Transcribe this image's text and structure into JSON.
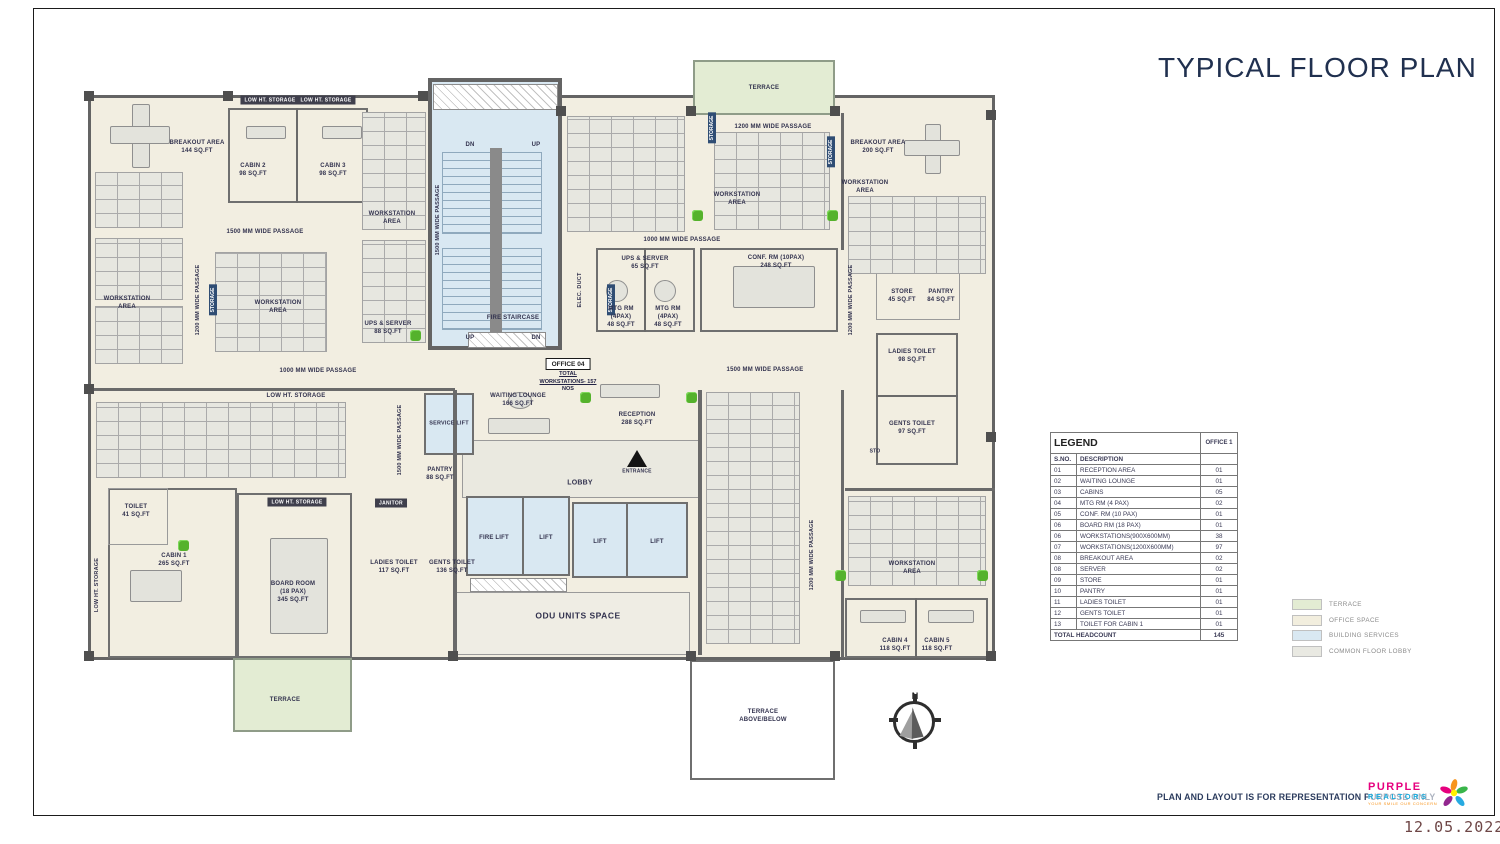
{
  "title": "TYPICAL FLOOR PLAN",
  "legend": {
    "title": "LEGEND",
    "office_header": "OFFICE 1",
    "sno_header": "S.NO.",
    "desc_header": "DESCRIPTION",
    "rows": [
      {
        "sno": "01",
        "desc": "RECEPTION AREA",
        "qty": "01"
      },
      {
        "sno": "02",
        "desc": "WAITING LOUNGE",
        "qty": "01"
      },
      {
        "sno": "03",
        "desc": "CABINS",
        "qty": "05"
      },
      {
        "sno": "04",
        "desc": "MTG RM (4 PAX)",
        "qty": "02"
      },
      {
        "sno": "05",
        "desc": "CONF. RM (10 PAX)",
        "qty": "01"
      },
      {
        "sno": "06",
        "desc": "BOARD RM (18 PAX)",
        "qty": "01"
      },
      {
        "sno": "06",
        "desc": "WORKSTATIONS(900X600MM)",
        "qty": "38"
      },
      {
        "sno": "07",
        "desc": "WORKSTATIONS(1200X600MM)",
        "qty": "97"
      },
      {
        "sno": "08",
        "desc": "BREAKOUT AREA",
        "qty": "02"
      },
      {
        "sno": "08",
        "desc": "SERVER",
        "qty": "02"
      },
      {
        "sno": "09",
        "desc": "STORE",
        "qty": "01"
      },
      {
        "sno": "10",
        "desc": "PANTRY",
        "qty": "01"
      },
      {
        "sno": "11",
        "desc": "LADIES TOILET",
        "qty": "01"
      },
      {
        "sno": "12",
        "desc": "GENTS TOILET",
        "qty": "01"
      },
      {
        "sno": "13",
        "desc": "TOILET FOR CABIN 1",
        "qty": "01"
      }
    ],
    "total_label": "TOTAL HEADCOUNT",
    "total_value": "145"
  },
  "color_legend": [
    {
      "label": "TERRACE",
      "color": "#e3ecd3"
    },
    {
      "label": "OFFICE SPACE",
      "color": "#f2eede"
    },
    {
      "label": "BUILDING SERVICES",
      "color": "#d9e8f2"
    },
    {
      "label": "COMMON FLOOR LOBBY",
      "color": "#e9e9e2"
    }
  ],
  "footer": {
    "disclaimer": "PLAN AND LAYOUT IS FOR REPRESENTATION PURPOSE ONLY",
    "date": "12.05.2022"
  },
  "logo": {
    "name": "PURPLE",
    "name2": "REALTORS",
    "tagline": "YOUR SMILE OUR CONCERN"
  },
  "compass": {
    "north": "N"
  },
  "plan": {
    "terrace": "TERRACE",
    "terrace_above": {
      "l1": "TERRACE",
      "l2": "ABOVE/BELOW"
    },
    "breakout_144": {
      "l1": "BREAKOUT AREA",
      "l2": "144 SQ.FT"
    },
    "breakout_200": {
      "l1": "BREAKOUT AREA",
      "l2": "200 SQ.FT"
    },
    "cabin1": {
      "l1": "CABIN 1",
      "l2": "265 SQ.FT"
    },
    "cabin2": {
      "l1": "CABIN 2",
      "l2": "98 SQ.FT"
    },
    "cabin3": {
      "l1": "CABIN 3",
      "l2": "98 SQ.FT"
    },
    "cabin4": {
      "l1": "CABIN 4",
      "l2": "118 SQ.FT"
    },
    "cabin5": {
      "l1": "CABIN 5",
      "l2": "118 SQ.FT"
    },
    "workstation_area": {
      "l1": "WORKSTATION",
      "l2": "AREA"
    },
    "low_ht_storage": "LOW HT. STORAGE",
    "storage": "STORAGE",
    "elec_duct": "ELEC. DUCT",
    "fire_staircase": "FIRE STAIRCASE",
    "dn": "DN",
    "up": "UP",
    "passage_1000": "1000 MM WIDE PASSAGE",
    "passage_1200": "1200 MM WIDE PASSAGE",
    "passage_1500": "1500 MM WIDE PASSAGE",
    "ups_server_88": {
      "l1": "UPS & SERVER",
      "l2": "88 SQ.FT"
    },
    "ups_server_65": {
      "l1": "UPS & SERVER",
      "l2": "65 SQ.FT"
    },
    "mtg_rm": {
      "l1": "MTG RM",
      "l2": "(4PAX)",
      "l3": "48 SQ.FT"
    },
    "conf_rm": {
      "l1": "CONF. RM (10PAX)",
      "l2": "248 SQ.FT"
    },
    "board_room": {
      "l1": "BOARD ROOM",
      "l2": "(18 PAX)",
      "l3": "345 SQ.FT"
    },
    "office_04": "OFFICE 04",
    "office_04_note": {
      "l1": "TOTAL",
      "l2": "WORKSTATIONS- 157",
      "l3": "NOS"
    },
    "waiting_lounge": {
      "l1": "WAITING LOUNGE",
      "l2": "166 SQ.FT"
    },
    "reception": {
      "l1": "RECEPTION",
      "l2": "288 SQ.FT"
    },
    "lobby": "LOBBY",
    "entrance": "ENTRANCE",
    "service_lift": "SERVICE LIFT",
    "fire_lift": "FIRE LIFT",
    "lift": "LIFT",
    "odu": "ODU UNITS SPACE",
    "pantry_88": {
      "l1": "PANTRY",
      "l2": "88 SQ.FT"
    },
    "janitor": "JANITOR",
    "ladies_117": {
      "l1": "LADIES TOILET",
      "l2": "117 SQ.FT"
    },
    "gents_136": {
      "l1": "GENTS TOILET",
      "l2": "136 SQ.FT"
    },
    "toilet_41": {
      "l1": "TOILET",
      "l2": "41 SQ.FT"
    },
    "store_45": {
      "l1": "STORE",
      "l2": "45 SQ.FT"
    },
    "pantry_84": {
      "l1": "PANTRY",
      "l2": "84 SQ.FT"
    },
    "ladies_98": {
      "l1": "LADIES TOILET",
      "l2": "98 SQ.FT"
    },
    "gents_97": {
      "l1": "GENTS TOILET",
      "l2": "97 SQ.FT"
    },
    "sto": "STO"
  }
}
